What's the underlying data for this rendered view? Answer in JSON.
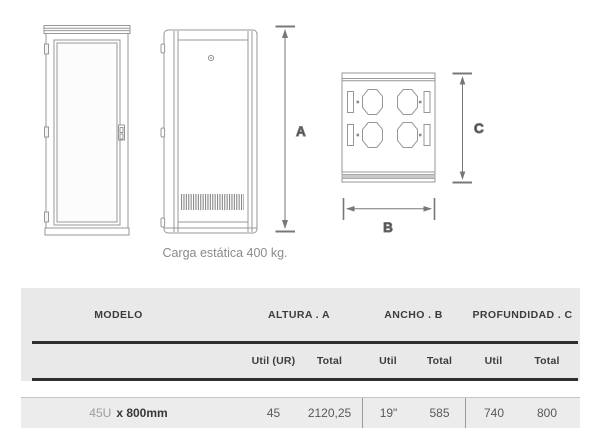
{
  "diagram": {
    "caption": "Carga estática 400 kg.",
    "labels": {
      "a": "A",
      "b": "B",
      "c": "C"
    }
  },
  "table": {
    "header": {
      "modelo": "MODELO",
      "altura": "ALTURA . A",
      "ancho": "ANCHO . B",
      "profundidad": "PROFUNDIDAD . C"
    },
    "subheader": {
      "altura_util": "Util (UR)",
      "altura_total": "Total",
      "ancho_util": "Util",
      "ancho_total": "Total",
      "profundidad_util": "Util",
      "profundidad_total": "Total"
    },
    "rows": [
      {
        "modelo_units": "45U",
        "modelo_size": "x 800mm",
        "altura_util": "45",
        "altura_total": "2120,25",
        "ancho_util": "19\"",
        "ancho_total": "585",
        "profundidad_util": "740",
        "profundidad_total": "800"
      }
    ]
  },
  "colors": {
    "outline": "#979797",
    "dimension": "#787878",
    "header_bg": "#e9e9e9",
    "row_bg": "#ececec",
    "rule": "#2e2e2e"
  }
}
